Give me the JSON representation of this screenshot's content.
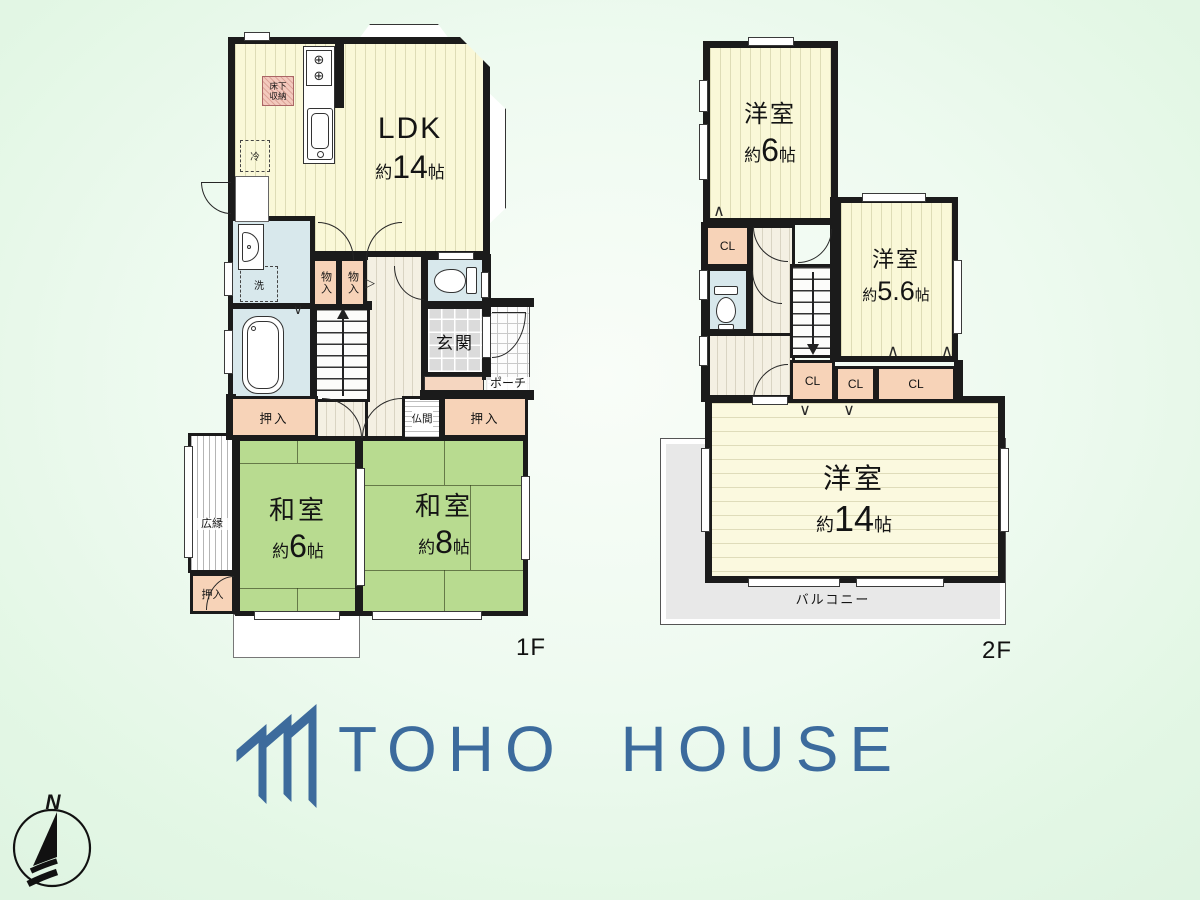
{
  "floor1": {
    "label": "1F",
    "ldk": {
      "name": "LDK",
      "about": "約",
      "value": "14",
      "unit": "帖"
    },
    "washitsu_6": {
      "name": "和室",
      "about": "約",
      "value": "6",
      "unit": "帖"
    },
    "washitsu_8": {
      "name": "和室",
      "about": "約",
      "value": "8",
      "unit": "帖"
    },
    "genkan": "玄関",
    "porch": "ポーチ",
    "hiroen": "広縁",
    "butsuma": "仏間",
    "oshiire": "押入",
    "monoire": "物入",
    "laundry": "洗",
    "fridge": "冷",
    "underfloor_storage": "床下収納"
  },
  "floor2": {
    "label": "2F",
    "yoshitsu_6": {
      "name": "洋室",
      "about": "約",
      "value": "6",
      "unit": "帖"
    },
    "yoshitsu_5_6": {
      "name": "洋室",
      "about": "約",
      "value": "5.6",
      "unit": "帖"
    },
    "yoshitsu_14": {
      "name": "洋室",
      "about": "約",
      "value": "14",
      "unit": "帖"
    },
    "closet": "CL",
    "balcony": "バルコニー"
  },
  "logo": {
    "text": "TOHO HOUSE",
    "color": "#3c6b9d"
  },
  "compass": {
    "north": "N"
  },
  "icons": {
    "burner": "⊕",
    "slide_mark": "▷",
    "swing_up": "∧",
    "swing_down": "∨"
  }
}
